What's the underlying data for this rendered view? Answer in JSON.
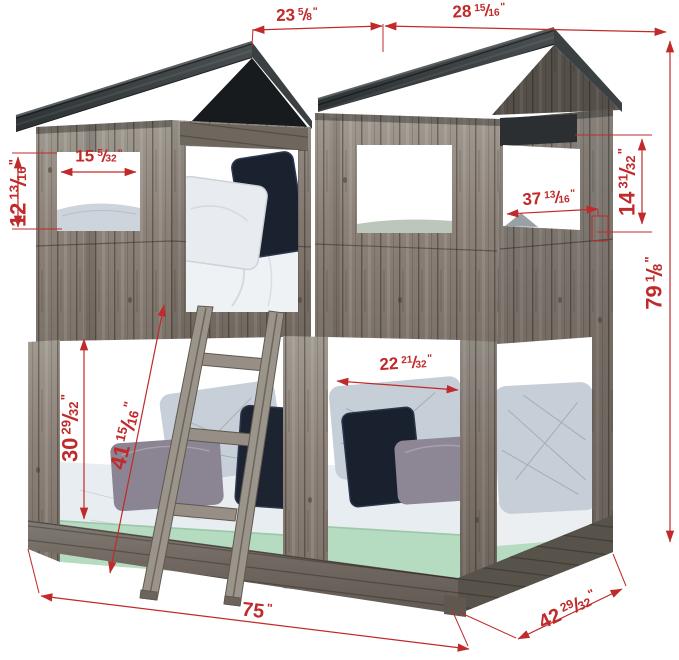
{
  "meta": {
    "type": "product-dimension-diagram",
    "subject": "rustic tower bunk bed with house roofs, ladder and two bunks"
  },
  "colors": {
    "dimension": "#c02a2a",
    "roof": "#32373a",
    "wood": "#8d8279",
    "wood_shadow": "#6b645b",
    "mattress_green": "#b5dbc1",
    "pillow_navy": "#1c2432",
    "pillow_gray_blue": "#c6ced7",
    "pillow_plum": "#8b8492",
    "background": "#ffffff"
  },
  "dimensions": {
    "roof_left_width": {
      "whole": "23",
      "num": "5",
      "slash": "/",
      "den": "8",
      "unit": "\""
    },
    "roof_right_width": {
      "whole": "28",
      "num": "15",
      "slash": "/",
      "den": "16",
      "unit": "\""
    },
    "overall_height": {
      "whole": "79",
      "num": "1",
      "slash": "/",
      "den": "8",
      "unit": "\""
    },
    "left_window_width": {
      "whole": "15",
      "num": "5",
      "slash": "/",
      "den": "32",
      "unit": "\""
    },
    "left_window_height": {
      "whole": "12",
      "num": "13",
      "slash": "/",
      "den": "16",
      "unit": "\""
    },
    "side_window_wall_width": {
      "whole": "37",
      "num": "13",
      "slash": "/",
      "den": "16",
      "unit": "\""
    },
    "side_window_height": {
      "whole": "14",
      "num": "31",
      "slash": "/",
      "den": "32",
      "unit": "\""
    },
    "lower_opening_width": {
      "whole": "22",
      "num": "21",
      "slash": "/",
      "den": "32",
      "unit": "\""
    },
    "lower_opening_height": {
      "whole": "30",
      "num": "29",
      "slash": "/",
      "den": "32",
      "unit": "\""
    },
    "ladder_length": {
      "whole": "41",
      "num": "15",
      "slash": "/",
      "den": "16",
      "unit": "\""
    },
    "overall_length": {
      "whole": "75",
      "num": "",
      "slash": "",
      "den": "",
      "unit": "\""
    },
    "overall_depth": {
      "whole": "42",
      "num": "29",
      "slash": "/",
      "den": "32",
      "unit": "\""
    }
  }
}
